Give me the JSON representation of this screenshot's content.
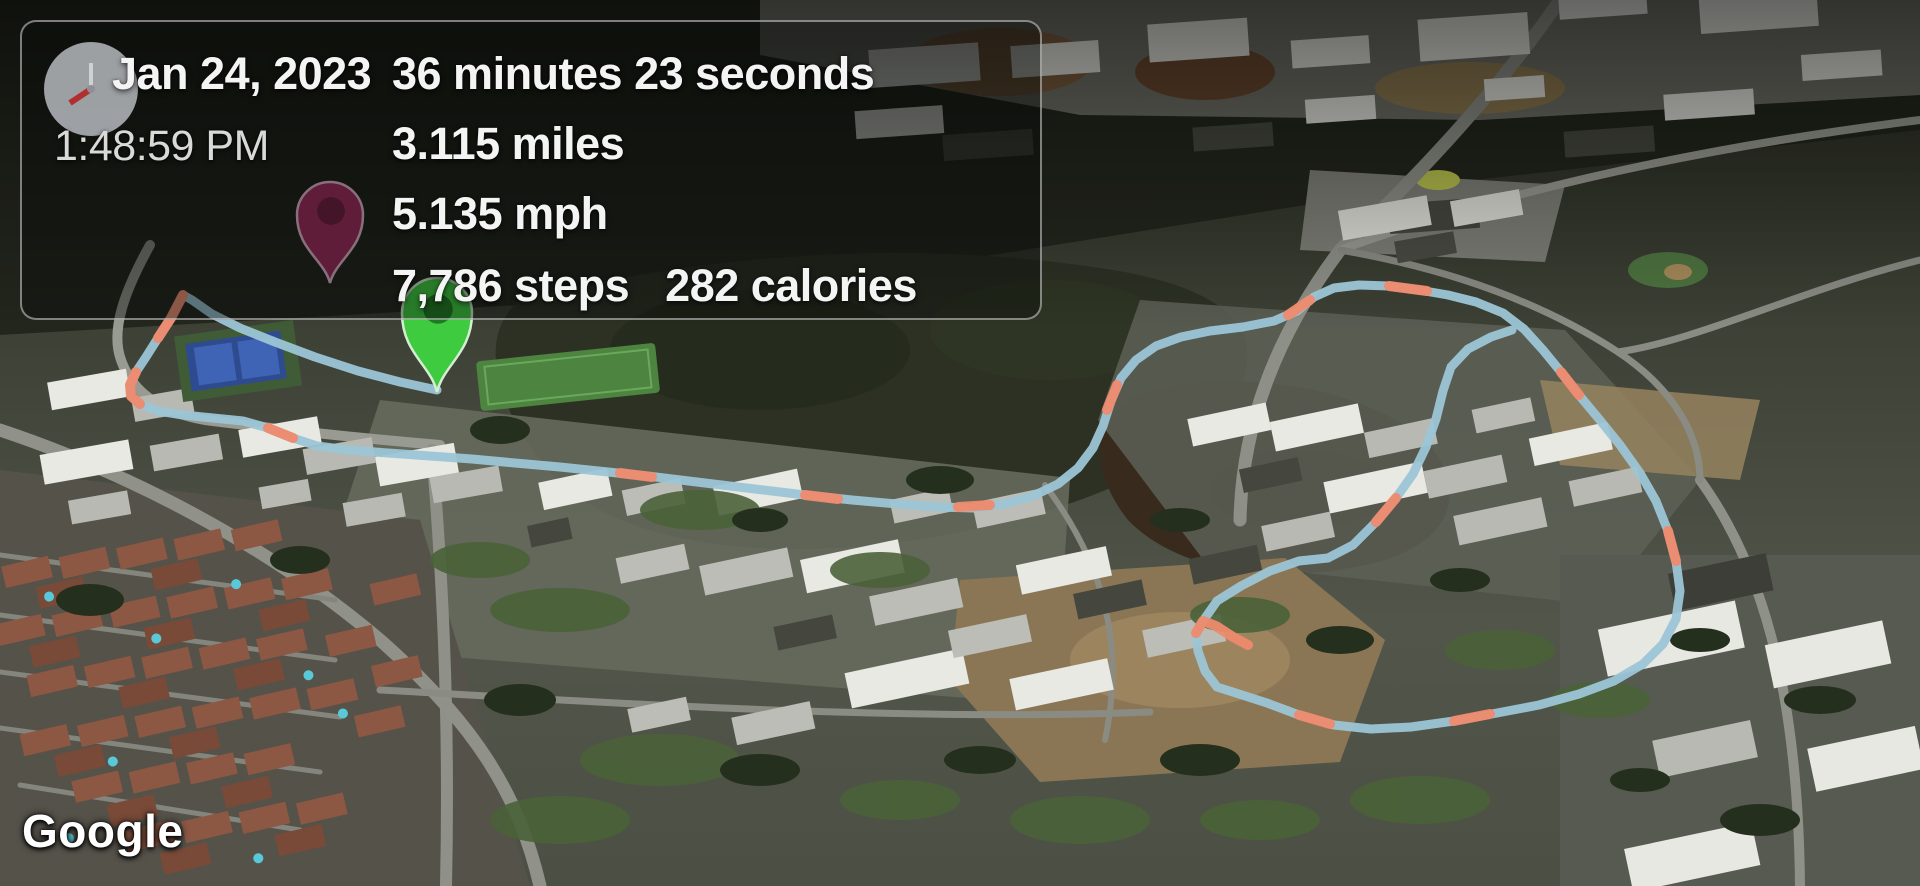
{
  "panel": {
    "date": "Jan 24, 2023",
    "time": "1:48:59 PM",
    "duration": "36 minutes 23 seconds",
    "distance": "3.115 miles",
    "speed": "5.135 mph",
    "steps": "7,786 steps",
    "calories": "282 calories"
  },
  "branding": {
    "watermark": "Google"
  },
  "map": {
    "route_color": "#9cc5d6",
    "route_highlight_color": "#ee8a6d",
    "route_width": 9,
    "route_points": [
      [
        437,
        390
      ],
      [
        400,
        382
      ],
      [
        358,
        371
      ],
      [
        315,
        357
      ],
      [
        275,
        342
      ],
      [
        240,
        328
      ],
      [
        212,
        314
      ],
      [
        192,
        300
      ],
      [
        183,
        295
      ],
      [
        171,
        318
      ],
      [
        158,
        338
      ],
      [
        146,
        357
      ],
      [
        136,
        372
      ],
      [
        130,
        385
      ],
      [
        131,
        396
      ],
      [
        140,
        404
      ],
      [
        158,
        411
      ],
      [
        183,
        415
      ],
      [
        213,
        418
      ],
      [
        243,
        421
      ],
      [
        268,
        428
      ],
      [
        293,
        438
      ],
      [
        317,
        446
      ],
      [
        348,
        450
      ],
      [
        388,
        453
      ],
      [
        430,
        456
      ],
      [
        472,
        459
      ],
      [
        515,
        463
      ],
      [
        560,
        467
      ],
      [
        608,
        472
      ],
      [
        656,
        477
      ],
      [
        705,
        483
      ],
      [
        755,
        489
      ],
      [
        805,
        495
      ],
      [
        852,
        500
      ],
      [
        897,
        504
      ],
      [
        938,
        507
      ],
      [
        973,
        508
      ],
      [
        1004,
        504
      ],
      [
        1033,
        496
      ],
      [
        1058,
        484
      ],
      [
        1078,
        468
      ],
      [
        1093,
        448
      ],
      [
        1103,
        426
      ],
      [
        1111,
        401
      ],
      [
        1121,
        378
      ],
      [
        1136,
        360
      ],
      [
        1156,
        346
      ],
      [
        1181,
        337
      ],
      [
        1210,
        331
      ],
      [
        1243,
        327
      ],
      [
        1274,
        321
      ],
      [
        1297,
        311
      ],
      [
        1314,
        297
      ],
      [
        1334,
        288
      ],
      [
        1359,
        285
      ],
      [
        1389,
        286
      ],
      [
        1419,
        290
      ],
      [
        1448,
        295
      ],
      [
        1476,
        302
      ],
      [
        1503,
        313
      ],
      [
        1524,
        329
      ],
      [
        1543,
        350
      ],
      [
        1561,
        372
      ],
      [
        1579,
        395
      ],
      [
        1599,
        419
      ],
      [
        1620,
        445
      ],
      [
        1640,
        473
      ],
      [
        1656,
        501
      ],
      [
        1668,
        531
      ],
      [
        1676,
        561
      ],
      [
        1680,
        591
      ],
      [
        1676,
        619
      ],
      [
        1663,
        644
      ],
      [
        1643,
        664
      ],
      [
        1614,
        681
      ],
      [
        1579,
        694
      ],
      [
        1539,
        705
      ],
      [
        1497,
        713
      ],
      [
        1454,
        721
      ],
      [
        1411,
        727
      ],
      [
        1371,
        729
      ],
      [
        1334,
        725
      ],
      [
        1299,
        715
      ],
      [
        1267,
        703
      ],
      [
        1239,
        694
      ],
      [
        1217,
        687
      ],
      [
        1205,
        671
      ],
      [
        1198,
        651
      ],
      [
        1196,
        633
      ],
      [
        1203,
        621
      ],
      [
        1217,
        601
      ],
      [
        1241,
        586
      ],
      [
        1270,
        571
      ],
      [
        1299,
        561
      ],
      [
        1328,
        558
      ],
      [
        1353,
        545
      ],
      [
        1376,
        522
      ],
      [
        1396,
        498
      ],
      [
        1413,
        474
      ],
      [
        1426,
        447
      ],
      [
        1436,
        419
      ],
      [
        1443,
        391
      ],
      [
        1451,
        367
      ],
      [
        1468,
        349
      ],
      [
        1491,
        337
      ],
      [
        1512,
        330
      ]
    ],
    "route_highlights": [
      [
        [
          183,
          295
        ],
        [
          171,
          318
        ],
        [
          158,
          338
        ]
      ],
      [
        [
          136,
          372
        ],
        [
          130,
          385
        ],
        [
          131,
          396
        ],
        [
          140,
          404
        ]
      ],
      [
        [
          268,
          428
        ],
        [
          293,
          438
        ]
      ],
      [
        [
          620,
          473
        ],
        [
          652,
          477
        ]
      ],
      [
        [
          805,
          495
        ],
        [
          838,
          499
        ]
      ],
      [
        [
          958,
          507
        ],
        [
          990,
          505
        ]
      ],
      [
        [
          1107,
          410
        ],
        [
          1117,
          385
        ]
      ],
      [
        [
          1288,
          315
        ],
        [
          1310,
          300
        ]
      ],
      [
        [
          1389,
          286
        ],
        [
          1427,
          291
        ]
      ],
      [
        [
          1561,
          372
        ],
        [
          1579,
          395
        ]
      ],
      [
        [
          1668,
          531
        ],
        [
          1676,
          561
        ]
      ],
      [
        [
          1454,
          721
        ],
        [
          1490,
          714
        ]
      ],
      [
        [
          1299,
          715
        ],
        [
          1330,
          724
        ]
      ],
      [
        [
          1196,
          633
        ],
        [
          1203,
          621
        ],
        [
          1216,
          626
        ],
        [
          1233,
          637
        ],
        [
          1248,
          645
        ]
      ],
      [
        [
          1376,
          522
        ],
        [
          1396,
          498
        ]
      ]
    ],
    "markers": {
      "end": {
        "x": 330,
        "y": 215,
        "head_r": 33,
        "tip_y": 283,
        "fill": "#9d2a5e",
        "inner": "#6e1c41",
        "outline": "#e3b7cf"
      },
      "start": {
        "x": 437,
        "y": 313,
        "head_r": 35,
        "tip_y": 392,
        "fill": "#3ecb40",
        "inner": "#1f7a22",
        "outline": "#d4eed2"
      }
    }
  }
}
